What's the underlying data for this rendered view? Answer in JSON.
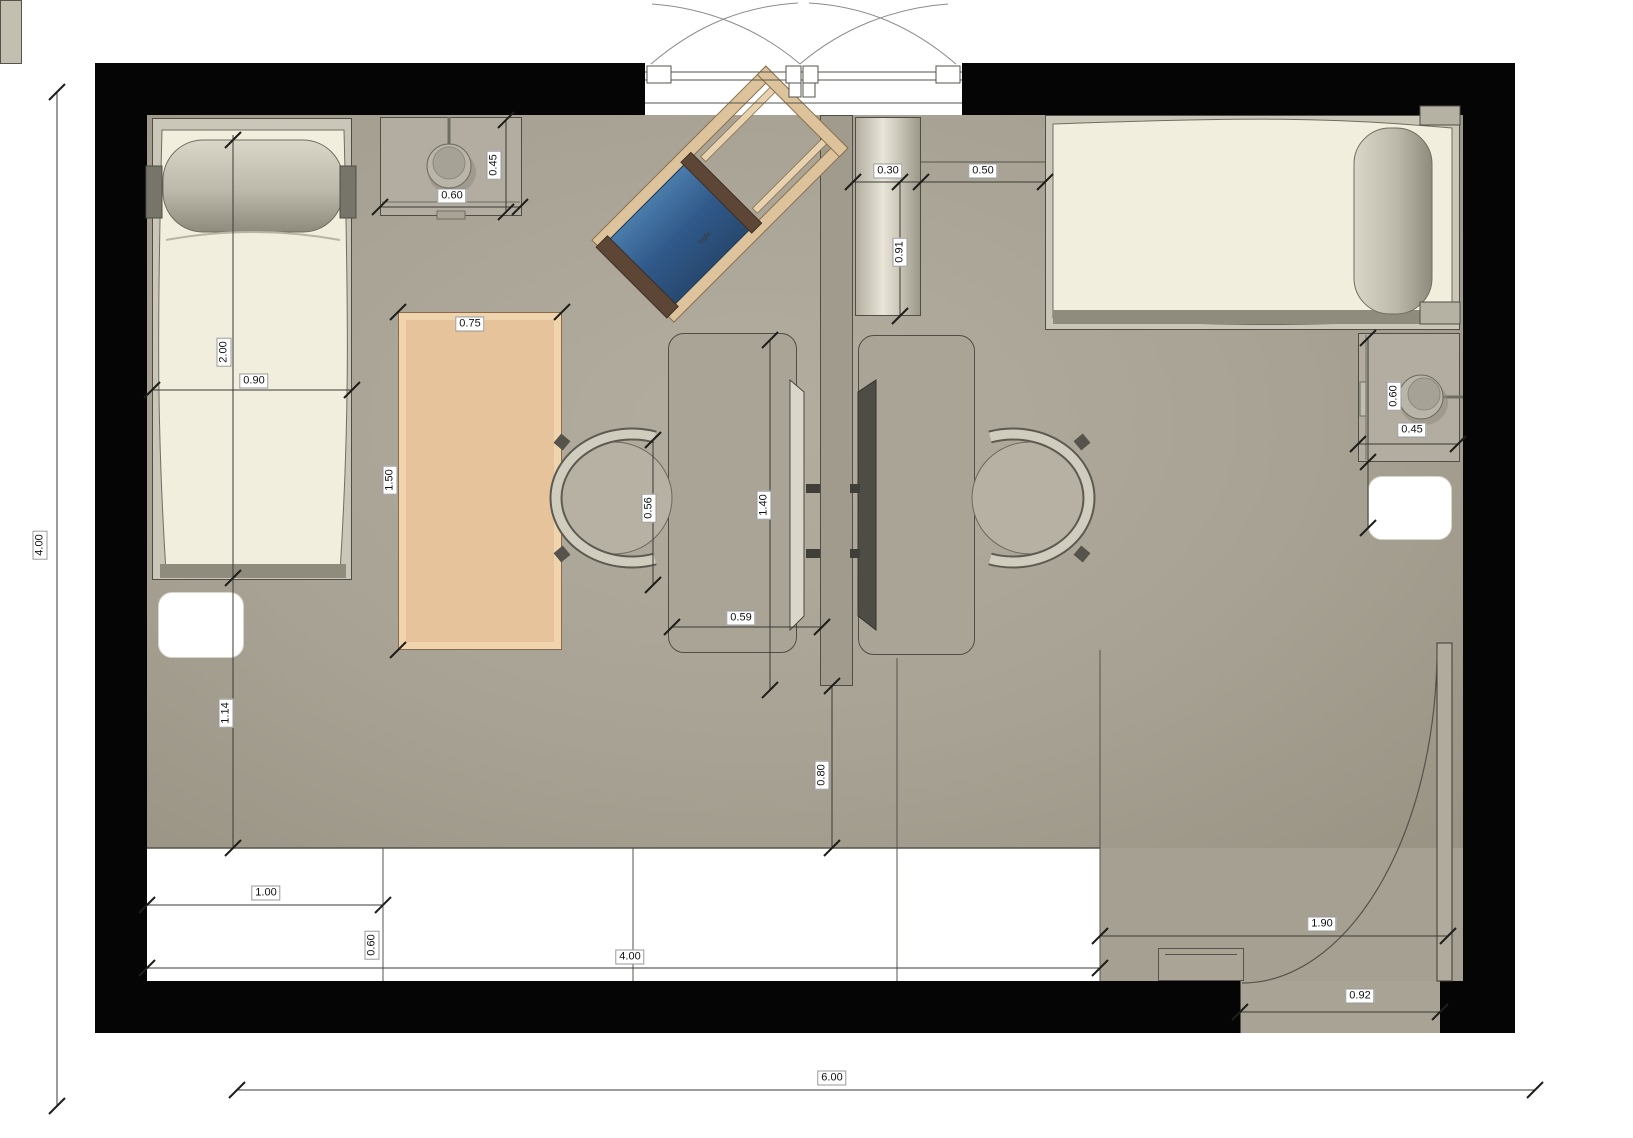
{
  "plan": {
    "type": "floor-plan-top-view",
    "deckchair_label": "sigla",
    "room_overall": {
      "width_m": "6.00",
      "depth_m": "4.00"
    },
    "colors": {
      "wall": "#050505",
      "floor": "#a8a294",
      "mattress": "#f1eedd",
      "rug_orange": "#e7c39c",
      "deckchair_canvas": "#3d6e9e",
      "deckchair_wood": "#dcc39c",
      "background": "#ffffff"
    },
    "dimensions": [
      {
        "id": "nightstand-left-depth",
        "text": "0.45",
        "x": 494,
        "y": 165,
        "rot": true
      },
      {
        "id": "nightstand-left-width",
        "text": "0.60",
        "x": 452,
        "y": 196,
        "rot": false
      },
      {
        "id": "cabinet-width",
        "text": "0.30",
        "x": 888,
        "y": 171,
        "rot": false
      },
      {
        "id": "cabinet-to-bed",
        "text": "0.50",
        "x": 983,
        "y": 171,
        "rot": false
      },
      {
        "id": "cabinet-length",
        "text": "0.91",
        "x": 900,
        "y": 252,
        "rot": true
      },
      {
        "id": "bed-left-length",
        "text": "2.00",
        "x": 224,
        "y": 352,
        "rot": true
      },
      {
        "id": "bed-left-width",
        "text": "0.90",
        "x": 254,
        "y": 381,
        "rot": false
      },
      {
        "id": "rug-width",
        "text": "0.75",
        "x": 470,
        "y": 324,
        "rot": false
      },
      {
        "id": "rug-length",
        "text": "1.50",
        "x": 390,
        "y": 480,
        "rot": true
      },
      {
        "id": "chair-width",
        "text": "0.56",
        "x": 649,
        "y": 508,
        "rot": true
      },
      {
        "id": "desk-length",
        "text": "1.40",
        "x": 764,
        "y": 505,
        "rot": true
      },
      {
        "id": "desk-depth",
        "text": "0.59",
        "x": 741,
        "y": 618,
        "rot": false
      },
      {
        "id": "nightstand-right-length",
        "text": "0.60",
        "x": 1394,
        "y": 396,
        "rot": true
      },
      {
        "id": "nightstand-right-width",
        "text": "0.45",
        "x": 1412,
        "y": 430,
        "rot": false
      },
      {
        "id": "bed-to-band",
        "text": "1.14",
        "x": 226,
        "y": 713,
        "rot": true
      },
      {
        "id": "partition-to-band",
        "text": "0.80",
        "x": 822,
        "y": 775,
        "rot": true
      },
      {
        "id": "band-1",
        "text": "1.00",
        "x": 266,
        "y": 893,
        "rot": false
      },
      {
        "id": "band-0-60",
        "text": "0.60",
        "x": 372,
        "y": 945,
        "rot": true
      },
      {
        "id": "band-4-00",
        "text": "4.00",
        "x": 630,
        "y": 957,
        "rot": false
      },
      {
        "id": "door-clearance",
        "text": "1.90",
        "x": 1322,
        "y": 924,
        "rot": false
      },
      {
        "id": "door-width",
        "text": "0.92",
        "x": 1360,
        "y": 996,
        "rot": false
      },
      {
        "id": "room-width",
        "text": "6.00",
        "x": 832,
        "y": 1078,
        "rot": false
      },
      {
        "id": "room-depth",
        "text": "4.00",
        "x": 40,
        "y": 545,
        "rot": true
      }
    ]
  }
}
